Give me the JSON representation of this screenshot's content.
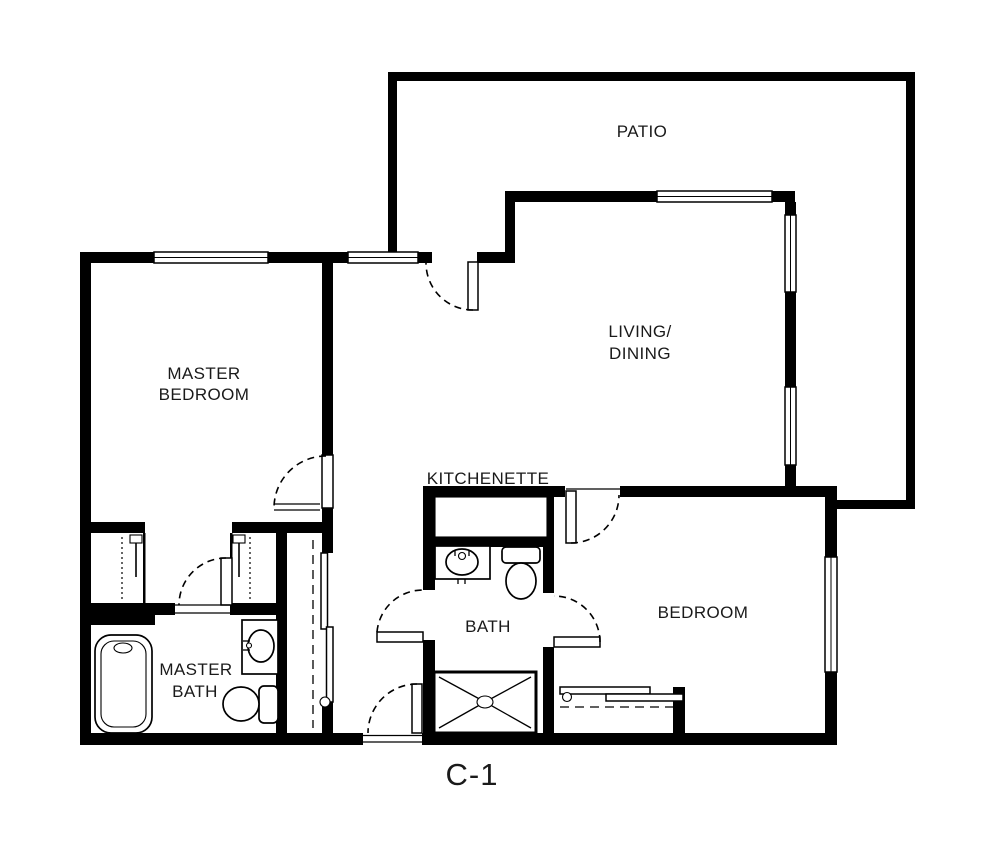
{
  "plan": {
    "label": "C-1",
    "rooms": {
      "patio": {
        "label": "PATIO"
      },
      "living_dining": {
        "line1": "LIVING/",
        "line2": "DINING"
      },
      "master_bedroom": {
        "line1": "MASTER",
        "line2": "BEDROOM"
      },
      "kitchenette": {
        "label": "KITCHENETTE"
      },
      "bath": {
        "label": "BATH"
      },
      "master_bath": {
        "line1": "MASTER",
        "line2": "BATH"
      },
      "bedroom": {
        "label": "BEDROOM"
      }
    },
    "fixtures": {
      "master_bath": [
        "bathtub",
        "vanity-sink",
        "toilet"
      ],
      "bath": [
        "vanity-sink",
        "toilet",
        "shower"
      ],
      "kitchenette": [
        "counter"
      ],
      "closets": [
        "closet-rod",
        "closet-shelf",
        "sliding-doors"
      ]
    },
    "colors": {
      "wall": "#000000",
      "background": "#ffffff",
      "label_text": "#1a1a1a"
    }
  }
}
